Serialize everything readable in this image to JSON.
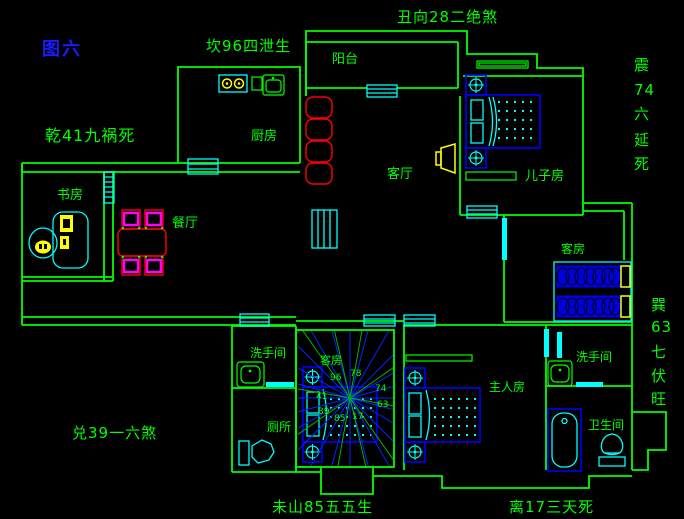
{
  "figure": {
    "label": "图六"
  },
  "fengshui": {
    "kan": "坎96四泄生",
    "chou": "丑向28二绝煞",
    "qian": "乾41九祸死",
    "zhen": [
      "震",
      "74",
      "六",
      "延",
      "死"
    ],
    "xun": [
      "巽",
      "63",
      "七",
      "伏",
      "旺"
    ],
    "dui": "兑39一六煞",
    "wei": "未山85五五生",
    "li": "离17三天死"
  },
  "rooms": {
    "balcony": "阳台",
    "kitchen": "厨房",
    "living": "客厅",
    "son": "儿子房",
    "study": "书房",
    "dining": "餐厅",
    "guest_right": "客房",
    "guest_center": "客房",
    "washroom_left": "洗手间",
    "toilet": "厕所",
    "master": "主人房",
    "washroom_right": "洗手间",
    "bathroom": "卫生间"
  },
  "compass": {
    "nw": "96",
    "n": "78",
    "ne": "74",
    "e": "63",
    "se": "17",
    "s": "85",
    "sw": "39",
    "w": "41"
  },
  "colors": {
    "wall": "#00ff00",
    "glass": "#00ffff",
    "furniture": "#0000ff",
    "accent": "#ffff00",
    "table": "#ff0000",
    "chair": "#ff00ff",
    "figure_label": "#1a1aff",
    "background": "#000000"
  }
}
